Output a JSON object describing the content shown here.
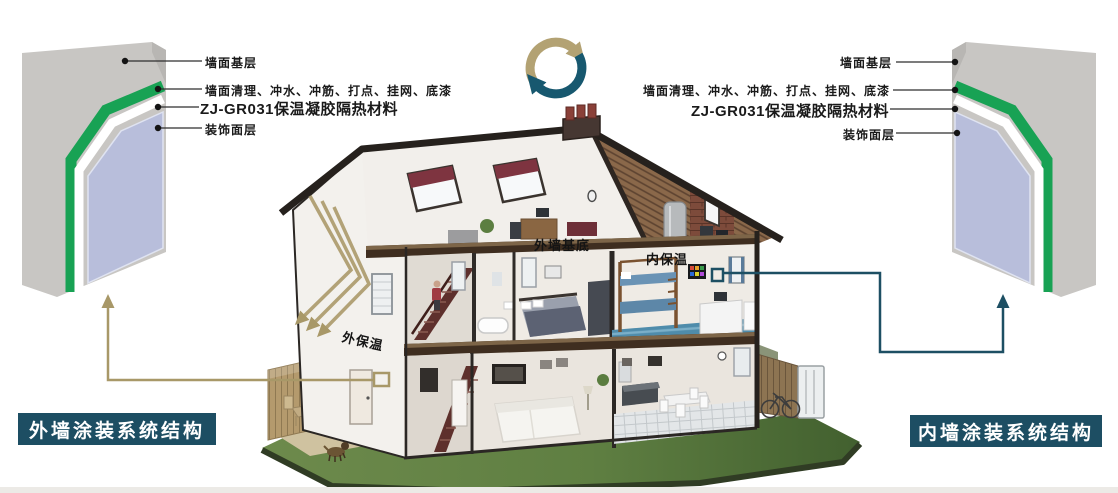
{
  "colors": {
    "accent_gold": "#ae9e72",
    "accent_teal": "#1d4f63",
    "layer_green": "#18a254",
    "layer_lavender": "#b8bedb",
    "layer_gray": "#c8c6c3",
    "title_box_bg": "#1d4e63",
    "title_text": "#ffffff",
    "lawn_green": "#5f7f42"
  },
  "icons": {
    "recycle_icon": "two-arrow-cycle",
    "reflect_arrows_icon": "triple-reflection-arrows"
  },
  "left_diagram": {
    "labels": [
      "墙面基层",
      "墙面清理、冲水、冲筋、打点、挂网、底漆",
      "ZJ-GR031保温凝胶隔热材料",
      "装饰面层"
    ],
    "title": "外墙涂装系统结构"
  },
  "right_diagram": {
    "labels": [
      "墙面基层",
      "墙面清理、冲水、冲筋、打点、挂网、底漆",
      "ZJ-GR031保温凝胶隔热材料",
      "装饰面层"
    ],
    "title": "内墙涂装系统结构"
  },
  "house": {
    "label_exterior_base": "外墙基底",
    "label_interior_insulation": "内保温",
    "label_exterior_insulation": "外保温"
  }
}
